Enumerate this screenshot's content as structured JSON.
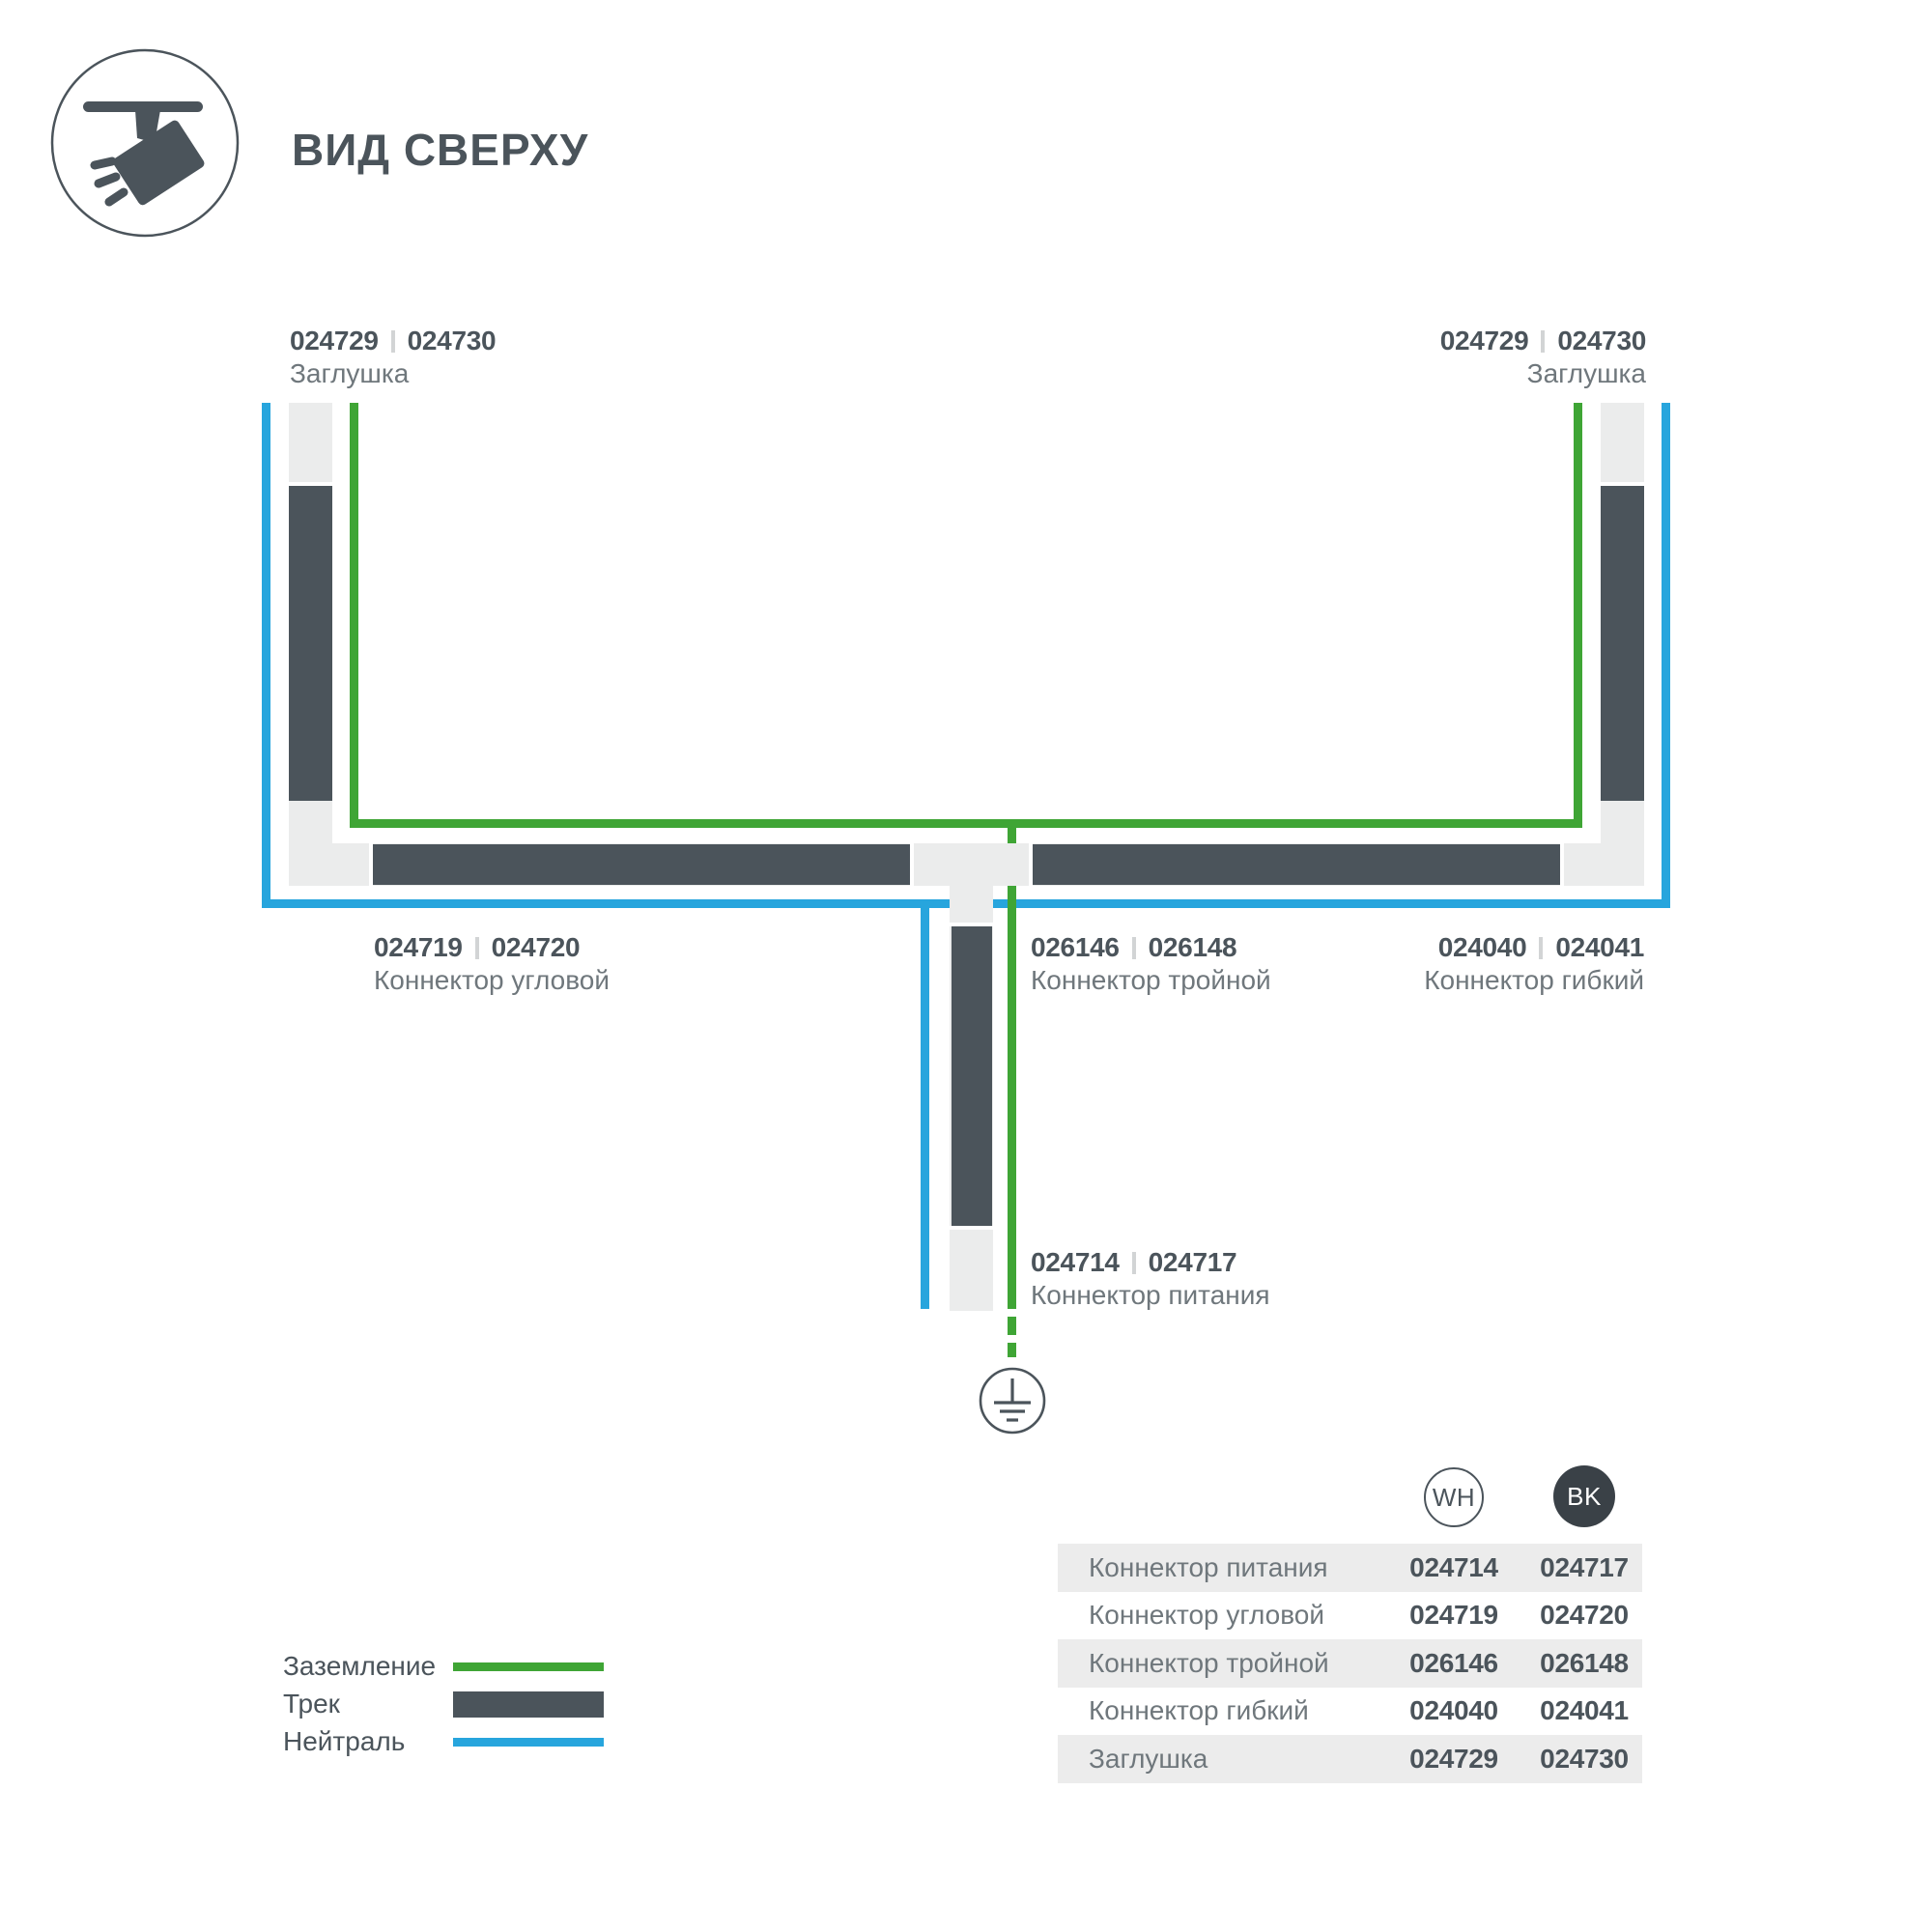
{
  "header": {
    "title": "ВИД СВЕРХУ",
    "icon": "track-spotlight-icon"
  },
  "divider": "|",
  "diagram": {
    "labels": {
      "endcap_left": {
        "code_wh": "024729",
        "code_bk": "024730",
        "name": "Заглушка"
      },
      "endcap_right": {
        "code_wh": "024729",
        "code_bk": "024730",
        "name": "Заглушка"
      },
      "corner": {
        "code_wh": "024719",
        "code_bk": "024720",
        "name": "Коннектор угловой"
      },
      "triple": {
        "code_wh": "026146",
        "code_bk": "026148",
        "name": "Коннектор тройной"
      },
      "flex": {
        "code_wh": "024040",
        "code_bk": "024041",
        "name": "Коннектор гибкий"
      },
      "power": {
        "code_wh": "024714",
        "code_bk": "024717",
        "name": "Коннектор питания"
      }
    },
    "colors": {
      "ground_wire": "#3fa535",
      "neutral_wire": "#27a5dd",
      "track": "#4b545b",
      "track_housing": "#ebecec"
    }
  },
  "legend": {
    "items": [
      {
        "label": "Заземление",
        "type": "ground"
      },
      {
        "label": "Трек",
        "type": "track"
      },
      {
        "label": "Нейтраль",
        "type": "neutral"
      }
    ]
  },
  "table": {
    "columns": [
      "WH",
      "BK"
    ],
    "rows": [
      {
        "label": "Коннектор питания",
        "wh": "024714",
        "bk": "024717"
      },
      {
        "label": "Коннектор угловой",
        "wh": "024719",
        "bk": "024720"
      },
      {
        "label": "Коннектор тройной",
        "wh": "026146",
        "bk": "026148"
      },
      {
        "label": "Коннектор гибкий",
        "wh": "024040",
        "bk": "024041"
      },
      {
        "label": "Заглушка",
        "wh": "024729",
        "bk": "024730"
      }
    ]
  }
}
